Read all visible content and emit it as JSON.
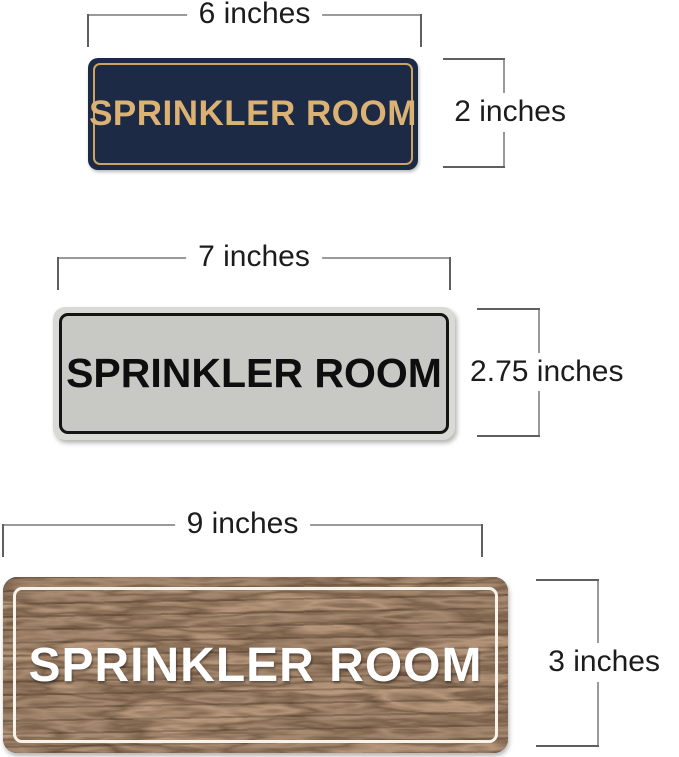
{
  "signs": [
    {
      "name": "navy-gold-sign",
      "label": "SPRINKLER ROOM",
      "width_label": "6 inches",
      "height_label": "2 inches",
      "bg_color": "#1d2a45",
      "text_color": "#dcb274",
      "border_color": "#cda361"
    },
    {
      "name": "silver-black-sign",
      "label": "SPRINKLER ROOM",
      "width_label": "7 inches",
      "height_label": "2.75 inches",
      "bg_color": "#c8c9c5",
      "rim_color": "#d9dad6",
      "text_color": "#0e0e0e",
      "border_color": "#141414"
    },
    {
      "name": "walnut-wood-sign",
      "label": "SPRINKLER ROOM",
      "width_label": "9 inches",
      "height_label": "3 inches",
      "bg_color": "#4e3526",
      "text_color": "#ffffff",
      "border_color": "#f6f3eb"
    }
  ],
  "annotation": {
    "line_color": "#9a9a9a",
    "tick_color": "#5f5f5f",
    "text_color": "#1c1c1c"
  }
}
